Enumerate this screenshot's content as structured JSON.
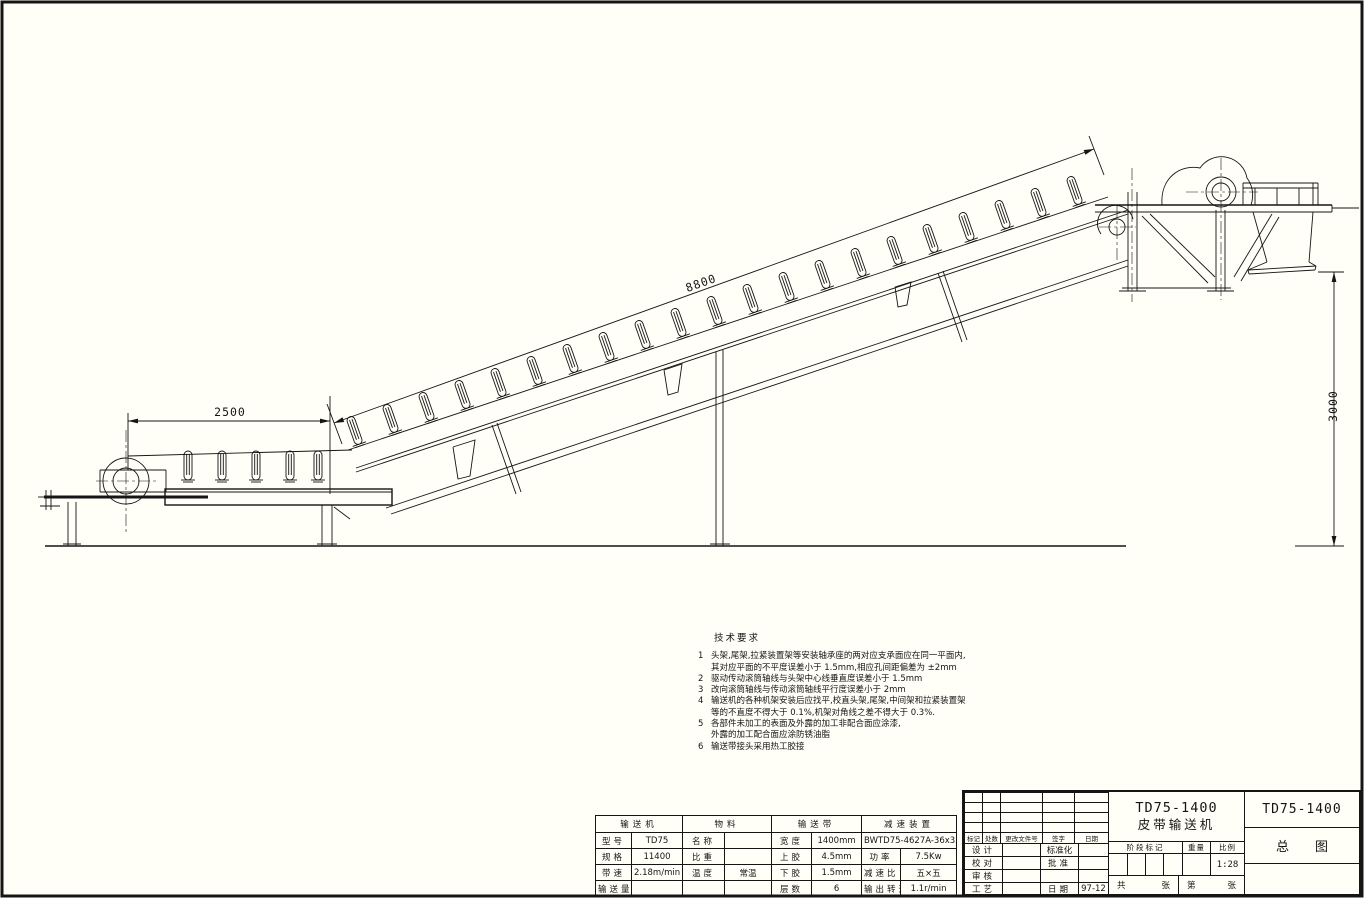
{
  "sheet": {
    "background": "#fffef7",
    "line_color": "#151515"
  },
  "dims": {
    "tail_span": "2500",
    "incline_length": "8800",
    "discharge_height": "3000"
  },
  "tech_notes": {
    "title": "技术要求",
    "items": [
      {
        "num": "1",
        "lines": [
          "头架,尾架,拉紧装置架等安装轴承座的两对应支承面应在同一平面内,",
          "其对应平面的不平度误差小于 1.5mm,相应孔间距偏差为 ±2mm"
        ]
      },
      {
        "num": "2",
        "lines": [
          "驱动传动滚筒轴线与头架中心线垂直度误差小于 1.5mm"
        ]
      },
      {
        "num": "3",
        "lines": [
          "改向滚筒轴线与传动滚筒轴线平行度误差小于 2mm"
        ]
      },
      {
        "num": "4",
        "lines": [
          "输送机的各种机架安装后应找平,校直头架,尾架,中间架和拉紧装置架",
          "等的不直度不得大于 0.1%,机架对角线之差不得大于 0.3%."
        ]
      },
      {
        "num": "5",
        "lines": [
          "各部件未加工的表面及外露的加工非配合面应涂漆,",
          "外露的加工配合面应涂防锈油脂"
        ]
      },
      {
        "num": "6",
        "lines": [
          "输送带接头采用热工胶接"
        ]
      }
    ]
  },
  "spec_table": {
    "section_headers": [
      "输送机",
      "物料",
      "输送带",
      "减速装置"
    ],
    "rows": [
      [
        "型号",
        "TD75",
        "名称",
        "",
        "宽度",
        "1400mm",
        "BWTD75-4627A-36x35"
      ],
      [
        "规格",
        "11400",
        "比重",
        "",
        "上胶",
        "4.5mm",
        "功率",
        "7.5Kw"
      ],
      [
        "带速",
        "2.18m/min",
        "温度",
        "常温",
        "下胶",
        "1.5mm",
        "减速比",
        "五×五"
      ],
      [
        "输送量",
        "",
        "",
        "",
        "层数",
        "6",
        "输出转速",
        "1.1r/min"
      ]
    ]
  },
  "title_block": {
    "rev_header": [
      "标记",
      "处数",
      "更改文件号",
      "签字",
      "日期"
    ],
    "sig_rows": [
      {
        "label": "设计",
        "label2": "标准化",
        "value2": ""
      },
      {
        "label": "校对",
        "label2": "批准",
        "value2": ""
      },
      {
        "label": "审核",
        "label2": "",
        "value2": ""
      },
      {
        "label": "工艺",
        "label2": "日期",
        "value2": "97-12"
      }
    ],
    "product_model": "TD75-1400",
    "product_name": "皮带输送机",
    "stage_label": "阶段标记",
    "weight_label": "重量",
    "scale_label": "比例",
    "scale_value": "1:28",
    "sheets": {
      "l1": "共",
      "l2": "张",
      "l3": "第",
      "l4": "张"
    },
    "drawing_no": "TD75-1400",
    "drawing_title": "总图"
  }
}
